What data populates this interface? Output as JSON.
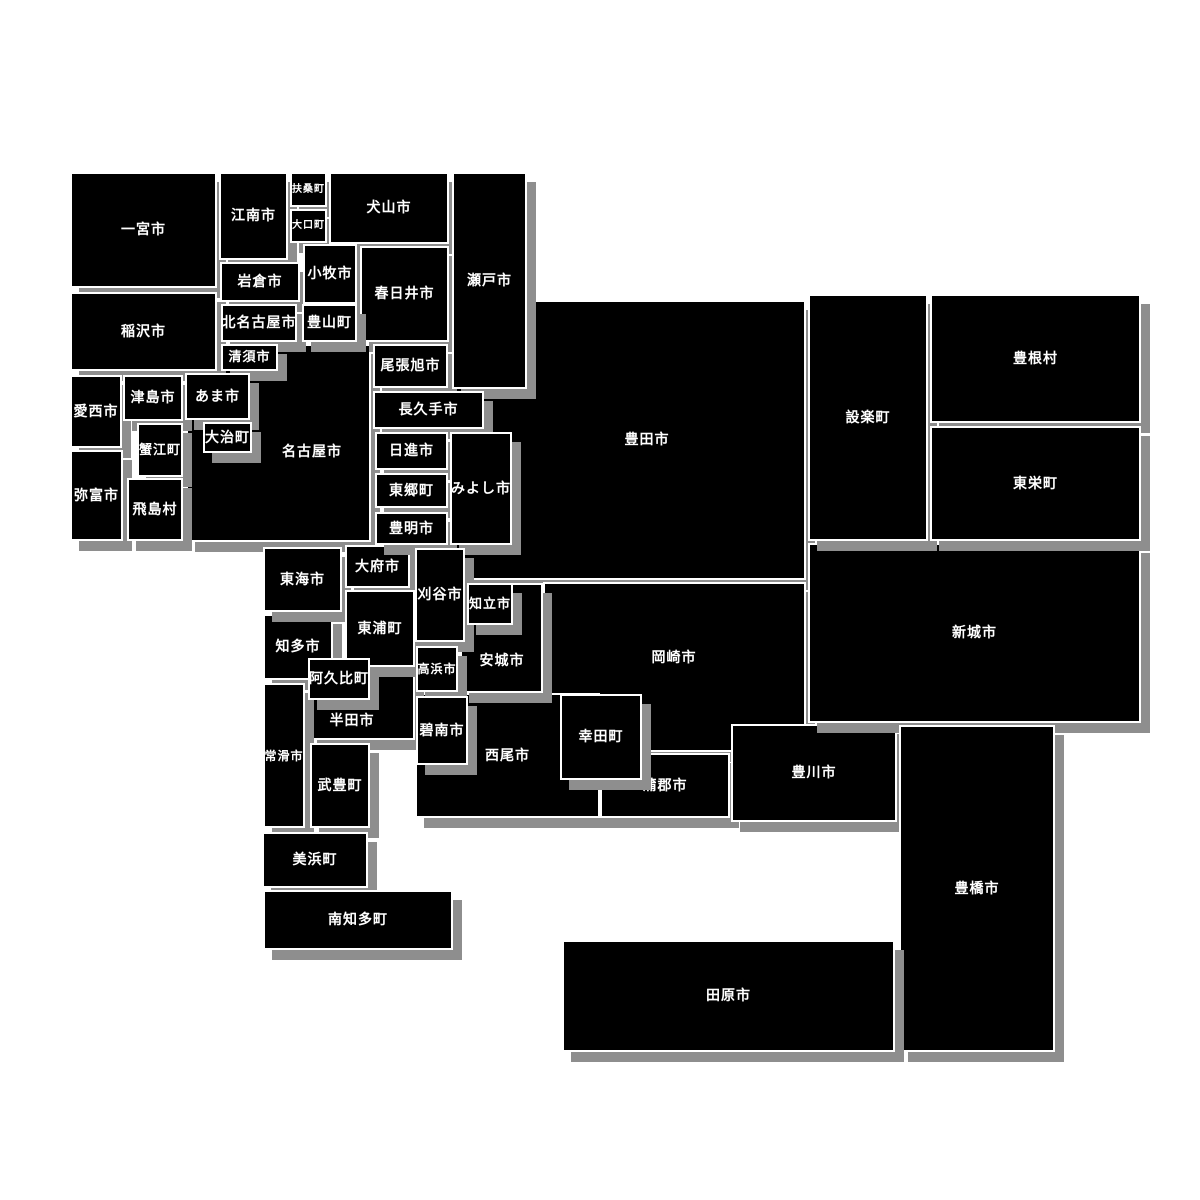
{
  "map": {
    "region": "愛知県",
    "colors": {
      "background": "#ffffff",
      "tile_fill": "#000000",
      "tile_border": "#ffffff",
      "tile_shadow": "#8e8e8e",
      "label_text": "#ffffff"
    },
    "tiles": [
      {
        "id": "nagoya",
        "name": "名古屋市",
        "x": 186,
        "y": 344,
        "w": 185,
        "h": 198,
        "label_x": 310,
        "label_y": 450
      },
      {
        "id": "toyota",
        "name": "豊田市",
        "x": 455,
        "y": 300,
        "w": 351,
        "h": 280,
        "label_x": 645,
        "label_y": 438
      },
      {
        "id": "okazaki",
        "name": "岡崎市",
        "x": 543,
        "y": 582,
        "w": 263,
        "h": 170,
        "label_x": 672,
        "label_y": 656
      },
      {
        "id": "nishio",
        "name": "西尾市",
        "x": 415,
        "y": 693,
        "w": 185,
        "h": 125
      },
      {
        "id": "gamagori",
        "name": "蒲郡市",
        "x": 600,
        "y": 753,
        "w": 130,
        "h": 65
      },
      {
        "id": "toyokawa",
        "name": "豊川市",
        "x": 731,
        "y": 724,
        "w": 166,
        "h": 98
      },
      {
        "id": "shinshiro",
        "name": "新城市",
        "x": 808,
        "y": 543,
        "w": 333,
        "h": 180
      },
      {
        "id": "shitara",
        "name": "設楽町",
        "x": 808,
        "y": 294,
        "w": 120,
        "h": 247
      },
      {
        "id": "toyone",
        "name": "豊根村",
        "x": 930,
        "y": 294,
        "w": 211,
        "h": 129
      },
      {
        "id": "toei",
        "name": "東栄町",
        "x": 930,
        "y": 426,
        "w": 211,
        "h": 115
      },
      {
        "id": "toyohashi",
        "name": "豊橋市",
        "x": 899,
        "y": 725,
        "w": 156,
        "h": 327
      },
      {
        "id": "tahara",
        "name": "田原市",
        "x": 562,
        "y": 940,
        "w": 333,
        "h": 112
      },
      {
        "id": "handa",
        "name": "半田市",
        "x": 308,
        "y": 667,
        "w": 107,
        "h": 73,
        "label_x": 350,
        "label_y": 719
      },
      {
        "id": "chita",
        "name": "知多市",
        "x": 263,
        "y": 614,
        "w": 70,
        "h": 66
      },
      {
        "id": "tokai",
        "name": "東海市",
        "x": 263,
        "y": 547,
        "w": 79,
        "h": 65
      },
      {
        "id": "obu",
        "name": "大府市",
        "x": 345,
        "y": 545,
        "w": 65,
        "h": 43
      },
      {
        "id": "higashiura",
        "name": "東浦町",
        "x": 345,
        "y": 590,
        "w": 70,
        "h": 77
      },
      {
        "id": "tokoname",
        "name": "常滑市",
        "x": 263,
        "y": 683,
        "w": 42,
        "h": 145
      },
      {
        "id": "taketoyo",
        "name": "武豊町",
        "x": 310,
        "y": 743,
        "w": 60,
        "h": 85
      },
      {
        "id": "mihama",
        "name": "美浜町",
        "x": 262,
        "y": 832,
        "w": 106,
        "h": 56
      },
      {
        "id": "minamichita",
        "name": "南知多町",
        "x": 263,
        "y": 890,
        "w": 190,
        "h": 60
      },
      {
        "id": "ichinomiya",
        "name": "一宮市",
        "x": 70,
        "y": 172,
        "w": 147,
        "h": 116
      },
      {
        "id": "konan",
        "name": "江南市",
        "x": 219,
        "y": 172,
        "w": 69,
        "h": 88
      },
      {
        "id": "fuso",
        "name": "扶桑町",
        "x": 290,
        "y": 172,
        "w": 37,
        "h": 35
      },
      {
        "id": "oguchi",
        "name": "大口町",
        "x": 290,
        "y": 209,
        "w": 37,
        "h": 34
      },
      {
        "id": "inuyama",
        "name": "犬山市",
        "x": 329,
        "y": 172,
        "w": 120,
        "h": 72
      },
      {
        "id": "iwakura",
        "name": "岩倉市",
        "x": 220,
        "y": 262,
        "w": 80,
        "h": 40
      },
      {
        "id": "komaki",
        "name": "小牧市",
        "x": 303,
        "y": 244,
        "w": 54,
        "h": 60
      },
      {
        "id": "kasugai",
        "name": "春日井市",
        "x": 360,
        "y": 246,
        "w": 89,
        "h": 96
      },
      {
        "id": "inazawa",
        "name": "稲沢市",
        "x": 70,
        "y": 292,
        "w": 147,
        "h": 79
      },
      {
        "id": "kitanagoya",
        "name": "北名古屋市",
        "x": 221,
        "y": 304,
        "w": 76,
        "h": 38
      },
      {
        "id": "toyoyama",
        "name": "豊山町",
        "x": 302,
        "y": 304,
        "w": 55,
        "h": 38
      },
      {
        "id": "kiyosu",
        "name": "清須市",
        "x": 221,
        "y": 344,
        "w": 57,
        "h": 27
      },
      {
        "id": "owariasahi",
        "name": "尾張旭市",
        "x": 373,
        "y": 344,
        "w": 75,
        "h": 44
      },
      {
        "id": "seto",
        "name": "瀬戸市",
        "x": 452,
        "y": 172,
        "w": 75,
        "h": 217
      },
      {
        "id": "aisai",
        "name": "愛西市",
        "x": 70,
        "y": 375,
        "w": 52,
        "h": 73
      },
      {
        "id": "tsushima",
        "name": "津島市",
        "x": 123,
        "y": 375,
        "w": 60,
        "h": 46
      },
      {
        "id": "kanie",
        "name": "蟹江町",
        "x": 137,
        "y": 423,
        "w": 46,
        "h": 54
      },
      {
        "id": "yatomi",
        "name": "弥富市",
        "x": 70,
        "y": 450,
        "w": 53,
        "h": 91
      },
      {
        "id": "tobishima",
        "name": "飛島村",
        "x": 127,
        "y": 478,
        "w": 56,
        "h": 63
      },
      {
        "id": "ama",
        "name": "あま市",
        "x": 185,
        "y": 373,
        "w": 65,
        "h": 47
      },
      {
        "id": "oharu",
        "name": "大治町",
        "x": 203,
        "y": 422,
        "w": 49,
        "h": 31
      },
      {
        "id": "nagakute",
        "name": "長久手市",
        "x": 373,
        "y": 391,
        "w": 111,
        "h": 38
      },
      {
        "id": "nisshin",
        "name": "日進市",
        "x": 375,
        "y": 432,
        "w": 73,
        "h": 38
      },
      {
        "id": "togo",
        "name": "東郷町",
        "x": 375,
        "y": 473,
        "w": 73,
        "h": 35
      },
      {
        "id": "toyoake",
        "name": "豊明市",
        "x": 375,
        "y": 512,
        "w": 73,
        "h": 33
      },
      {
        "id": "miyoshi",
        "name": "みよし市",
        "x": 450,
        "y": 432,
        "w": 62,
        "h": 113
      },
      {
        "id": "anjo",
        "name": "安城市",
        "x": 460,
        "y": 583,
        "w": 83,
        "h": 110,
        "label_x": 500,
        "label_y": 659
      },
      {
        "id": "kariya",
        "name": "刈谷市",
        "x": 415,
        "y": 548,
        "w": 50,
        "h": 94
      },
      {
        "id": "chiryu",
        "name": "知立市",
        "x": 467,
        "y": 583,
        "w": 46,
        "h": 42
      },
      {
        "id": "takahama",
        "name": "高浜市",
        "x": 416,
        "y": 646,
        "w": 42,
        "h": 46
      },
      {
        "id": "hekinan",
        "name": "碧南市",
        "x": 416,
        "y": 696,
        "w": 52,
        "h": 69
      },
      {
        "id": "kota",
        "name": "幸田町",
        "x": 560,
        "y": 694,
        "w": 82,
        "h": 86
      },
      {
        "id": "agui",
        "name": "阿久比町",
        "x": 308,
        "y": 658,
        "w": 62,
        "h": 42
      }
    ]
  }
}
